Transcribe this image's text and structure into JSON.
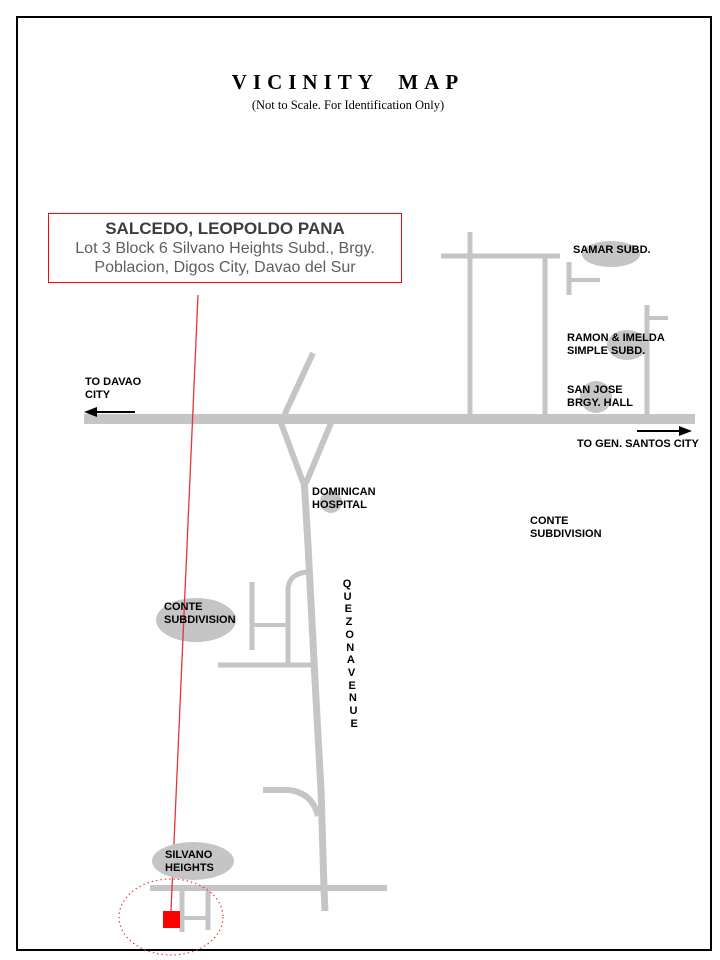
{
  "header": {
    "title": "VICINITY MAP",
    "subtitle": "(Not to Scale. For Identification Only)"
  },
  "callout": {
    "owner": "SALCEDO, LEOPOLDO PANA",
    "address_line1": "Lot 3  Block 6 Silvano Heights Subd., Brgy.",
    "address_line2": "Poblacion,  Digos City,  Davao del Sur"
  },
  "map": {
    "labels": {
      "samar": {
        "line1": "SAMAR SUBD."
      },
      "ramon_imelda": {
        "line1": "RAMON & IMELDA",
        "line2": "SIMPLE SUBD."
      },
      "san_jose": {
        "line1": "SAN JOSE",
        "line2": "BRGY. HALL"
      },
      "to_gen_santos": {
        "line1": "TO GEN. SANTOS CITY"
      },
      "to_davao": {
        "line1": "TO DAVAO",
        "line2": "CITY"
      },
      "dominican": {
        "line1": "DOMINICAN",
        "line2": "HOSPITAL"
      },
      "conte_right": {
        "line1": "CONTE",
        "line2": "SUBDIVISION"
      },
      "conte_left": {
        "line1": "CONTE",
        "line2": "SUBDIVISION"
      },
      "silvano": {
        "line1": "SILVANO",
        "line2": "HEIGHTS"
      }
    },
    "street": {
      "name": "QUEZON AVENUE"
    },
    "colors": {
      "road": "#c5c5c5",
      "landmark": "#c5c5c5",
      "marker": "#f90400",
      "route": "#e03636",
      "highlight": "#f23030",
      "arrow": "#000000",
      "callout_border": "#fe0202"
    }
  }
}
